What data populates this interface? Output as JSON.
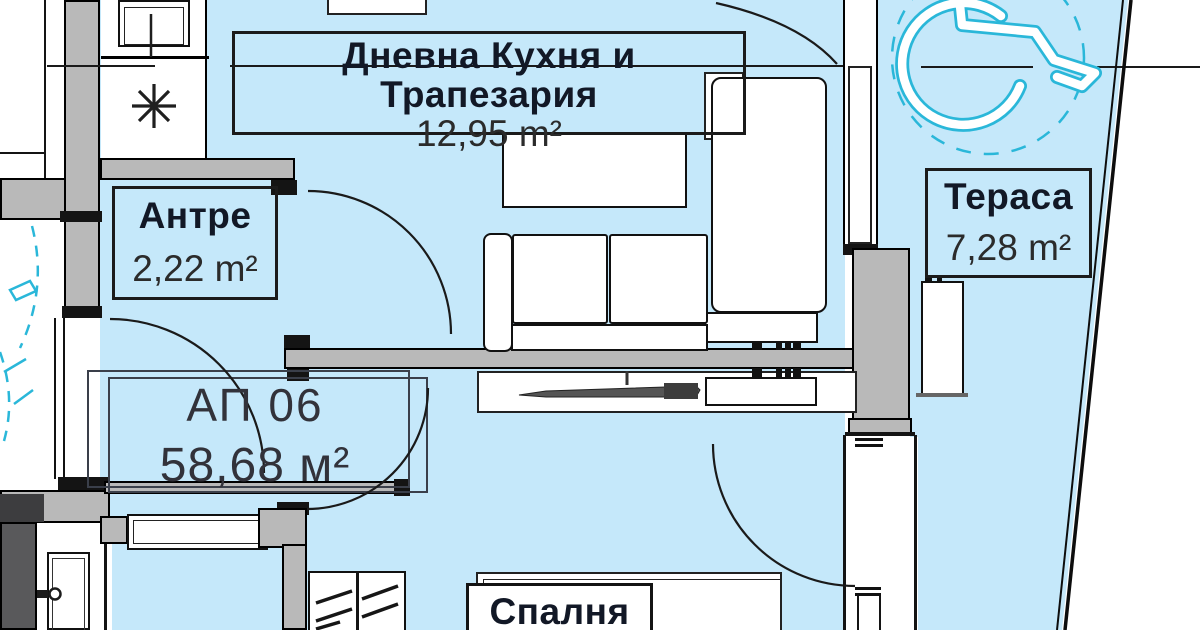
{
  "rooms": {
    "living": {
      "name": "Дневна Кухня и Трапезария",
      "area": "12,95 m²"
    },
    "hall": {
      "name": "Антре",
      "area": "2,22 m²"
    },
    "terrace": {
      "name": "Тераса",
      "area": "7,28 m²"
    },
    "bedroom": {
      "name": "Спалня"
    }
  },
  "apartment": {
    "id": "АП 06",
    "area": "58,68 м²"
  },
  "icons": {
    "accessibility": "wheelchair-accessible-icon",
    "cooktop": "cooktop-burner-icon",
    "sink": "kitchen-sink-icon",
    "door_handle": "door-handle-icon"
  },
  "colors": {
    "floor": "#c5e8fa",
    "walls": "#b9b9b9",
    "accent_cyan": "#2ab7d9",
    "linework": "#141414",
    "paper": "#ffffff"
  }
}
